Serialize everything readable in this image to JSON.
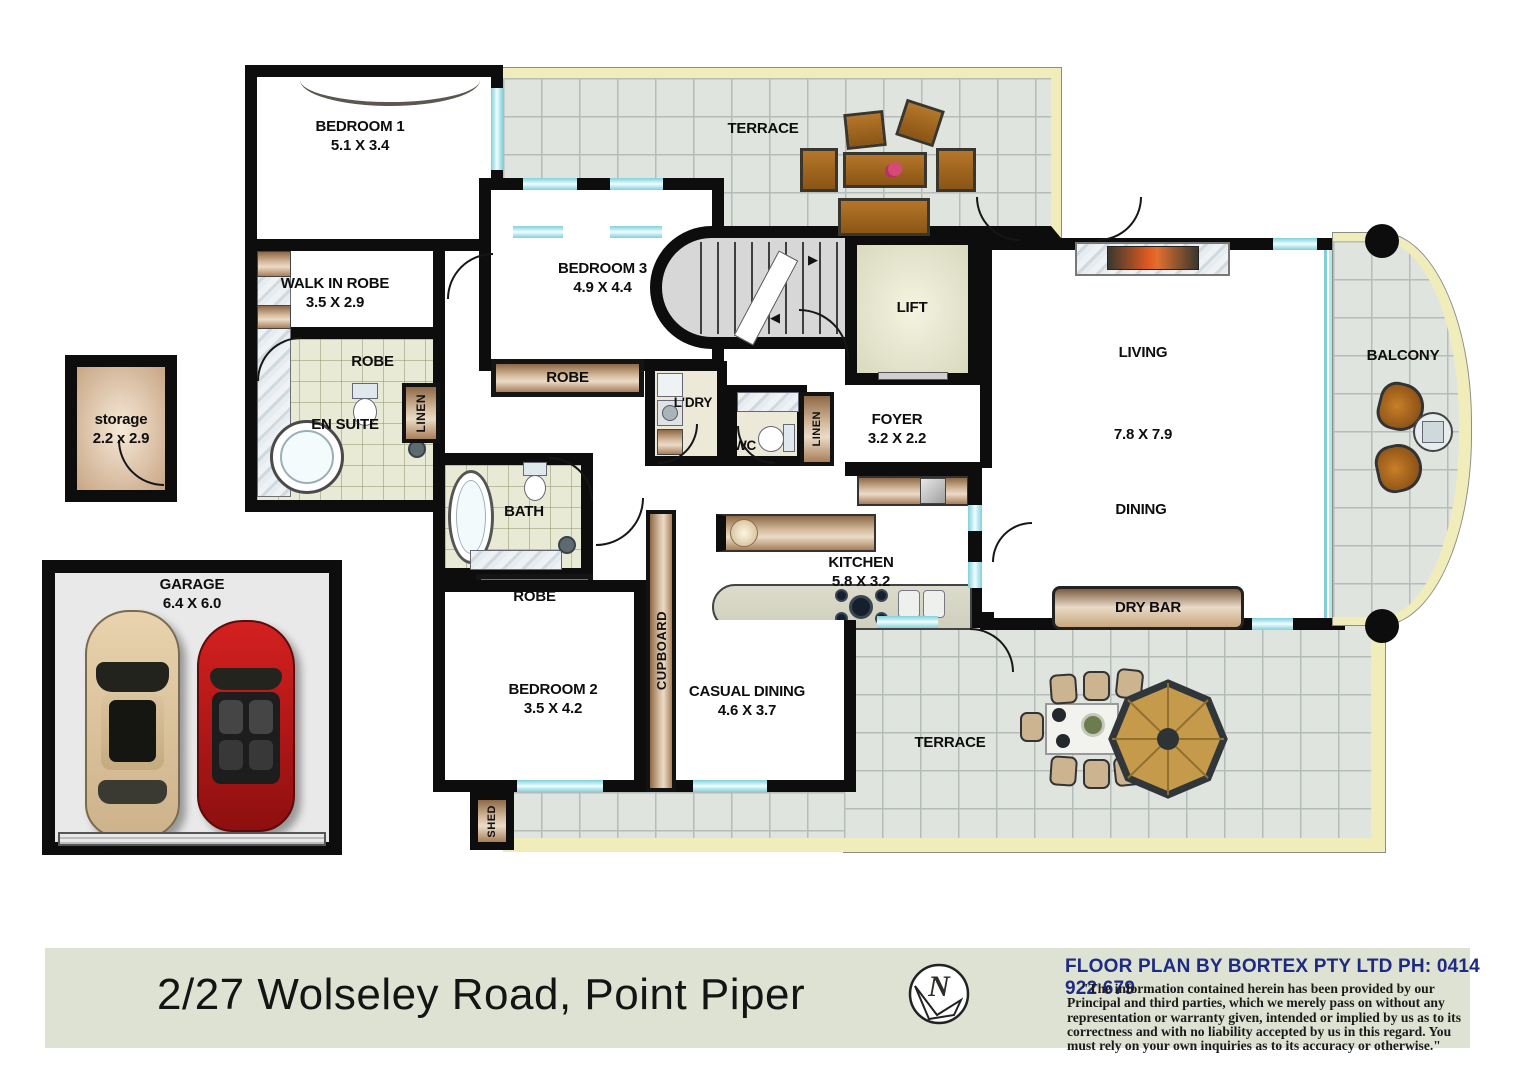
{
  "meta": {
    "address": "2/27 Wolseley Road, Point Piper",
    "compass_letter": "N"
  },
  "branding": {
    "provider_line": "FLOOR PLAN BY BORTEX PTY LTD PH: 0414 922 679",
    "disclaimer": "\"The information contained herein has been provided by our Principal and third parties, which we merely pass on without any representation or warranty given, intended or implied by us as to its correctness and with no liability accepted by us in this regard. You must rely on your own inquiries as to its accuracy or otherwise.\""
  },
  "rooms": {
    "bedroom1": {
      "label": "BEDROOM 1",
      "dims": "5.1 X 3.4"
    },
    "bedroom2": {
      "label": "BEDROOM 2",
      "dims": "3.5 X 4.2"
    },
    "bedroom3": {
      "label": "BEDROOM 3",
      "dims": "4.9 X 4.4"
    },
    "walk_in_robe": {
      "label": "WALK IN ROBE",
      "dims": "3.5 X 2.9"
    },
    "en_suite": {
      "label": "EN SUITE"
    },
    "bath": {
      "label": "BATH"
    },
    "wc": {
      "label": "WC"
    },
    "laundry": {
      "label": "L'DRY"
    },
    "linen_a": {
      "label": "LINEN"
    },
    "linen_b": {
      "label": "LINEN"
    },
    "robe_a": {
      "label": "ROBE"
    },
    "robe_b": {
      "label": "ROBE"
    },
    "robe_c": {
      "label": "ROBE"
    },
    "lift": {
      "label": "LIFT"
    },
    "foyer": {
      "label": "FOYER",
      "dims": "3.2 X 2.2"
    },
    "cupboard_a": {
      "label": "CUPBOARD"
    },
    "cupboard_b": {
      "label": "CUPBOARD"
    },
    "living": {
      "label": "LIVING",
      "dims": "7.8 X 7.9"
    },
    "dining": {
      "label": "DINING"
    },
    "balcony": {
      "label": "BALCONY"
    },
    "kitchen": {
      "label": "KITCHEN",
      "dims": "5.8 X 3.2"
    },
    "dry_bar": {
      "label": "DRY BAR"
    },
    "casual_dining": {
      "label": "CASUAL DINING",
      "dims": "4.6 X 3.7"
    },
    "terrace_top": {
      "label": "TERRACE"
    },
    "terrace_bottom": {
      "label": "TERRACE"
    },
    "storage": {
      "label": "storage",
      "dims": "2.2 x 2.9"
    },
    "garage": {
      "label": "GARAGE",
      "dims": "6.4 X 6.0"
    },
    "shed": {
      "label": "SHED"
    }
  },
  "colors": {
    "wall": "#0d0d0d",
    "window": "#aee9f2",
    "terrace_edge": "#f1edbb",
    "robe_wood": "#c9a87f",
    "footer_bg": "#dde2d2",
    "provider_text": "#1e2b82"
  }
}
